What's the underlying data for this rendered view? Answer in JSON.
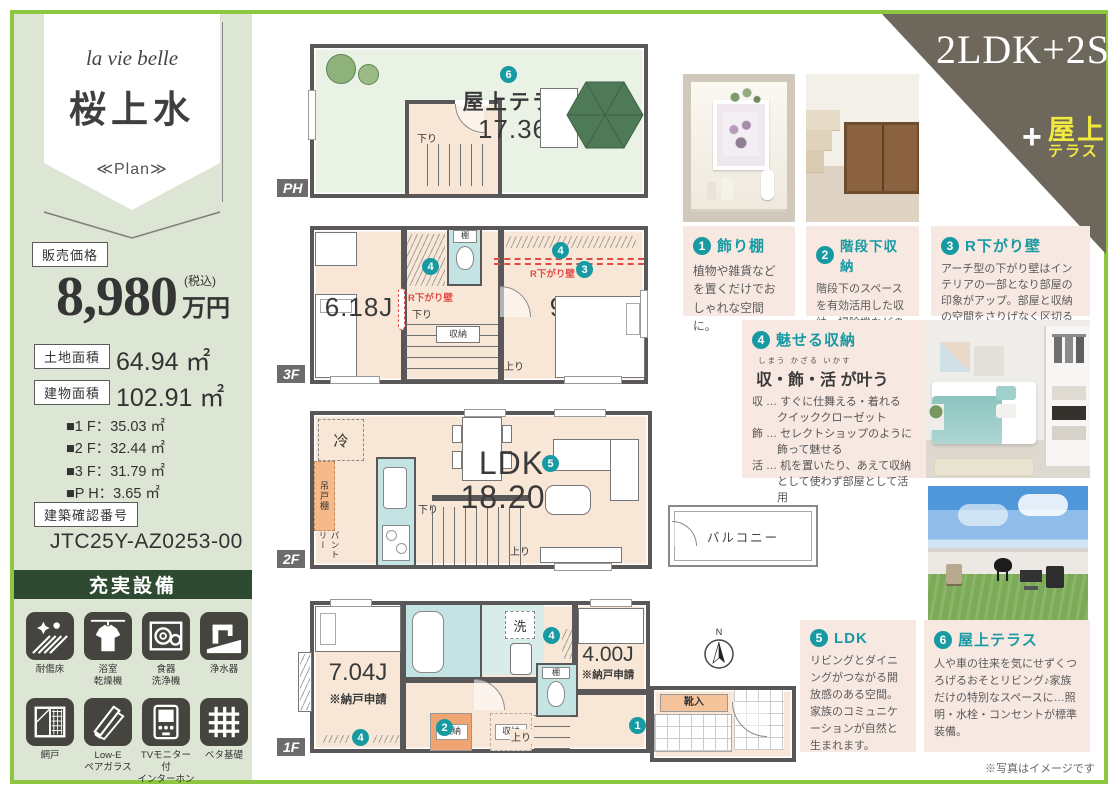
{
  "sidebar": {
    "brand": "la vie belle",
    "name": "桜上水",
    "plan": "≪Plan≫",
    "price_label": "販売価格",
    "price_value": "8,980",
    "price_tax": "(税込)",
    "price_unit": "万円",
    "land_label": "土地面積",
    "land_value": "64.94 ㎡",
    "bldg_label": "建物面積",
    "bldg_value": "102.91 ㎡",
    "floors": [
      "■1 F：35.03 ㎡",
      "■2 F：32.44 ㎡",
      "■3 F：31.79 ㎡",
      "■P H：3.65 ㎡"
    ],
    "conf_label": "建築確認番号",
    "conf_value": "JTC25Y-AZ0253-00",
    "equip_title": "充実設備",
    "equip": [
      {
        "icon": "scratch-proof-floor-icon",
        "label": "耐傷床"
      },
      {
        "icon": "bathroom-dryer-icon",
        "label": "浴室\n乾燥機"
      },
      {
        "icon": "dishwasher-icon",
        "label": "食器\n洗浄機"
      },
      {
        "icon": "water-purifier-icon",
        "label": "浄水器"
      },
      {
        "icon": "screen-door-icon",
        "label": "網戸"
      },
      {
        "icon": "lowe-pair-glass-icon",
        "label": "Low-E\nペアガラス"
      },
      {
        "icon": "tv-intercom-icon",
        "label": "TVモニター付\nインターホン"
      },
      {
        "icon": "slab-foundation-icon",
        "label": "ベタ基礎"
      }
    ]
  },
  "badge": {
    "main": "2LDK+2S",
    "plus": "+",
    "roof_top": "屋上",
    "roof_bottom": "テラス"
  },
  "plans": {
    "ph": {
      "tag": "PH",
      "title": "屋上テラス",
      "size": "17.36J",
      "num": "6",
      "down": "下り"
    },
    "f3": {
      "tag": "3F",
      "left": "6.18J",
      "right": "9.47J",
      "rwall": "R下がり壁",
      "rwall2": "R下がり壁",
      "shelf": "棚",
      "closet": "収納",
      "down": "下り",
      "up": "上り",
      "num3": "3",
      "num4a": "4",
      "num4b": "4"
    },
    "f2": {
      "tag": "2F",
      "ldk": "LDK",
      "size": "18.20J",
      "num": "5",
      "fridge": "冷",
      "hang": "吊戸棚",
      "pantry": "パントリー",
      "down": "下り",
      "up": "上り",
      "balcony": "バルコニー"
    },
    "f1": {
      "tag": "1F",
      "left": "7.04J",
      "left_note": "※納戸申請",
      "right": "4.00J",
      "right_note": "※納戸申請",
      "wash": "洗",
      "shelf": "棚",
      "closet1": "収納",
      "closet2": "収納",
      "shoe": "靴入",
      "up": "上り",
      "num1": "1",
      "num2": "2",
      "num4a": "4",
      "num4b": "4",
      "compass": "N"
    }
  },
  "callouts": [
    {
      "num": "1",
      "title": "飾り棚",
      "body": "植物や雑貨などを置くだけでおしゃれな空間に。"
    },
    {
      "num": "2",
      "title": "階段下収納",
      "body": "階段下のスペースを有効活用した収納。掃除機などの収納に便利。"
    },
    {
      "num": "3",
      "title": "R下がり壁",
      "body": "アーチ型の下がり壁はインテリアの一部となり部屋の印象がアップ。部屋と収納の空間をさりげなく区切る効果もあります。"
    },
    {
      "num": "4",
      "title": "魅せる収納",
      "furigana": "しまう かざる いかす",
      "subtitle": "収・飾・活 が叶う",
      "lines": [
        "収 … すぐに仕舞える・着れる",
        "クイッククローゼット",
        "飾 … セレクトショップのように",
        "飾って魅せる",
        "活 … 机を置いたり、あえて収納",
        "として使わず部屋として活用"
      ]
    },
    {
      "num": "5",
      "title": "LDK",
      "body": "リビングとダイニングがつながる開放感のある空間。家族のコミュニケーションが自然と生まれます。"
    },
    {
      "num": "6",
      "title": "屋上テラス",
      "body": "人や車の往来を気にせずくつろげるおそとリビング♪家族だけの特別なスペースに…照明・水栓・コンセントが標準装備。"
    }
  ],
  "footer": {
    "note": "※写真はイメージです"
  }
}
